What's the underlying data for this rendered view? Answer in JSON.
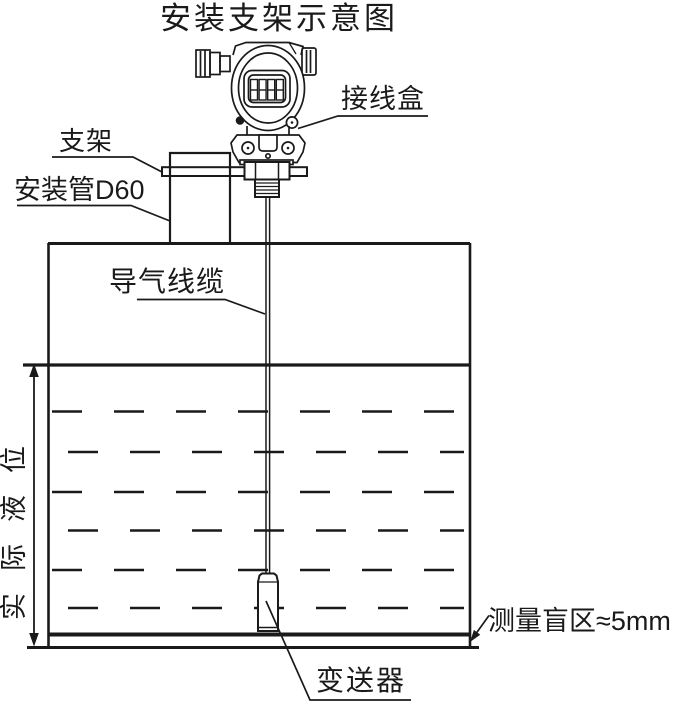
{
  "title": "安装支架示意图",
  "labels": {
    "junction_box": "接线盒",
    "bracket": "支架",
    "mounting_pipe": "安装管D60",
    "air_cable": "导气线缆",
    "actual_level": "实际液位",
    "blind_zone": "测量盲区≈5mm",
    "transmitter": "变送器"
  },
  "head_display": "8888",
  "colors": {
    "line": "#1a1a1a",
    "background": "#ffffff"
  }
}
